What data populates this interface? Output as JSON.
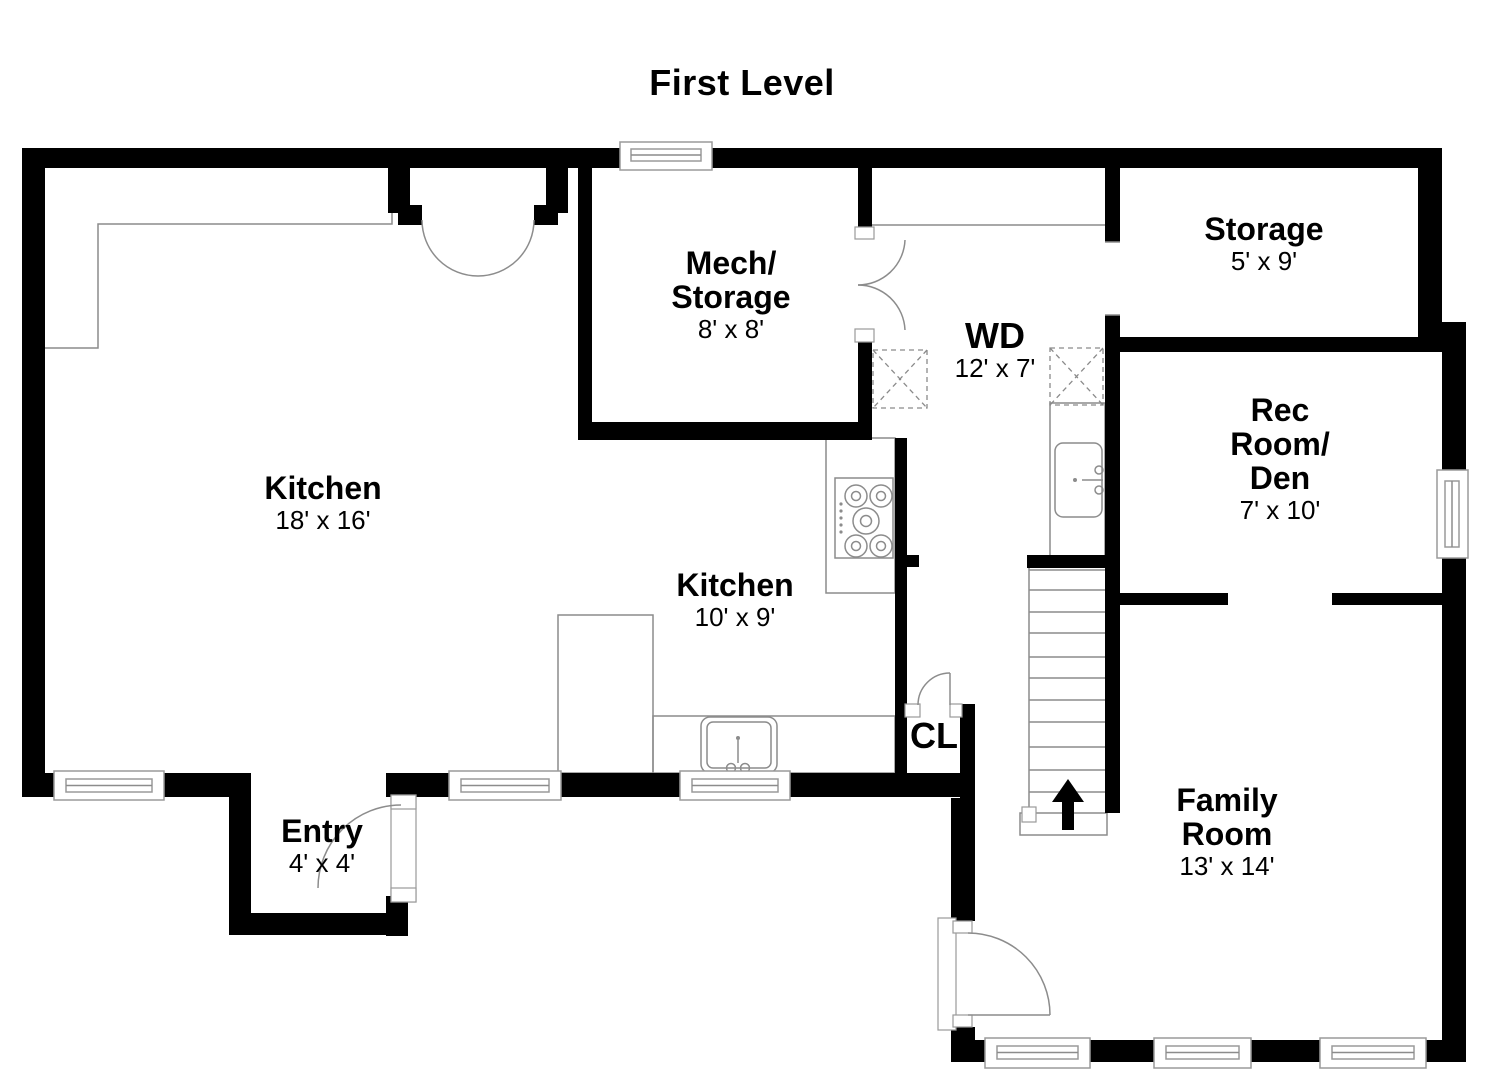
{
  "title": "First Level",
  "colors": {
    "wall": "#000000",
    "line": "#8c8c8c",
    "background": "#ffffff",
    "text": "#000000"
  },
  "rooms": {
    "kitchen_main": {
      "name": "Kitchen",
      "dims": "18' x 16'"
    },
    "mech_storage": {
      "name_line1": "Mech/",
      "name_line2": "Storage",
      "dims": "8' x 8'"
    },
    "storage": {
      "name": "Storage",
      "dims": "5' x 9'"
    },
    "laundry": {
      "name": "WD",
      "dims": "12' x 7'"
    },
    "rec_room": {
      "name_line1": "Rec",
      "name_line2": "Room/",
      "name_line3": "Den",
      "dims": "7' x 10'"
    },
    "kitchen_small": {
      "name": "Kitchen",
      "dims": "10' x 9'"
    },
    "closet": {
      "name": "CL"
    },
    "entry": {
      "name": "Entry",
      "dims": "4' x 4'"
    },
    "family_room": {
      "name_line1": "Family",
      "name_line2": "Room",
      "dims": "13' x 14'"
    }
  }
}
